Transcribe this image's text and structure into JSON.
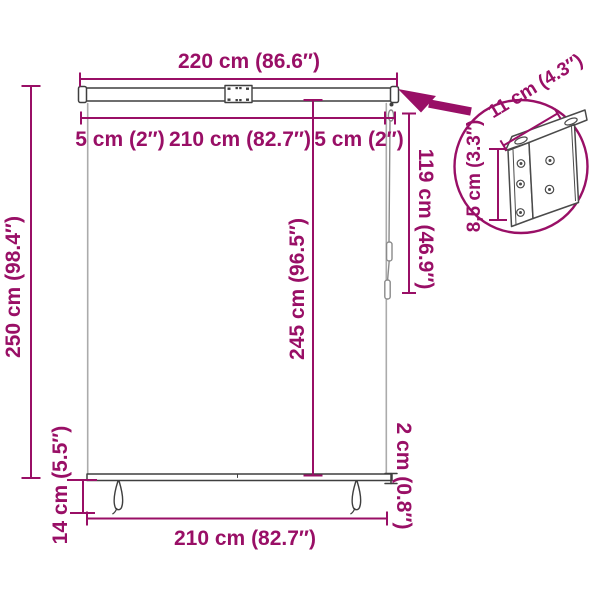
{
  "diagram": {
    "type": "product-dimension-diagram",
    "subject": "roller-blind-with-mounting-bracket"
  },
  "labels": {
    "total_width": "220 cm (86.6″)",
    "side_gap_left": "5 cm (2″)",
    "fabric_width_top": "210 cm (82.7″)",
    "side_gap_right": "5 cm (2″)",
    "right_drop": "119 cm (46.9″)",
    "center_drop": "245 cm (96.5″)",
    "total_height": "250 cm (98.4″)",
    "bottom_gap": "14 cm (5.5″)",
    "fabric_width_bottom": "210 cm (82.7″)",
    "bottom_bar_thickness": "2 cm (0.8″)",
    "bracket_depth": "11 cm (4.3″)",
    "bracket_height": "8,5 cm (3.3″)"
  },
  "colors": {
    "dimension_accent": "#990F66",
    "product_line_dark": "#3F3F3F",
    "product_line_light": "#ABABAB",
    "background": "#FFFFFF"
  }
}
